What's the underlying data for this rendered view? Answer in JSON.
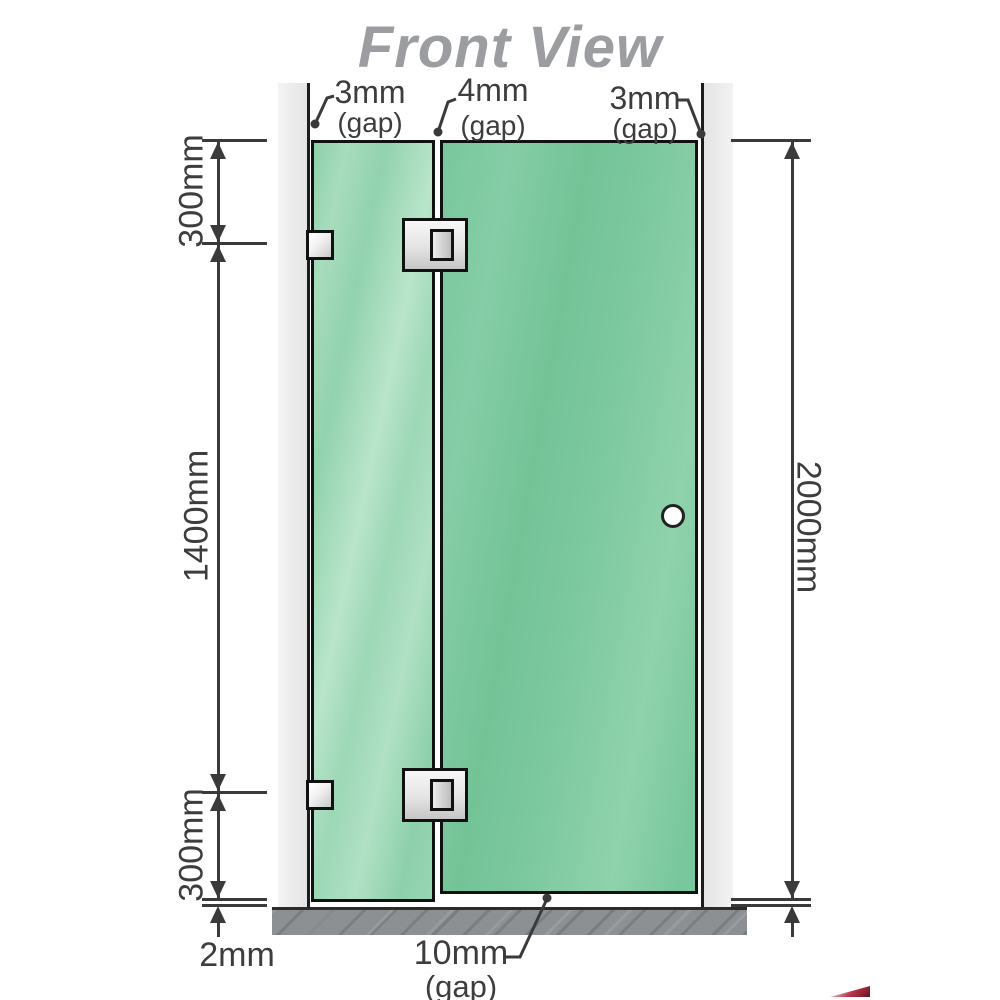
{
  "title": "Front View",
  "dimensions": {
    "top_left_gap": {
      "value": "3mm",
      "label": "(gap)"
    },
    "top_mid_gap": {
      "value": "4mm",
      "label": "(gap)"
    },
    "top_right_gap": {
      "value": "3mm",
      "label": "(gap)"
    },
    "left_top": "300mm",
    "left_middle": "1400mm",
    "left_bottom": "300mm",
    "right_height": "2000mm",
    "bottom_floor_gap": "2mm",
    "bottom_door_gap": {
      "value": "10mm",
      "label": "(gap)"
    }
  },
  "colors": {
    "glass_fixed": "#9bd6b4",
    "glass_door": "#76c59a",
    "wall": "#e9e9e9",
    "wall_edge": "#1c1c1c",
    "floor": "#8d9093",
    "title_text": "#9b9da0",
    "dimension_text": "#3d3d3d",
    "hardware_silver": "#d9d9d9",
    "watermark_red": "#8e1021"
  }
}
